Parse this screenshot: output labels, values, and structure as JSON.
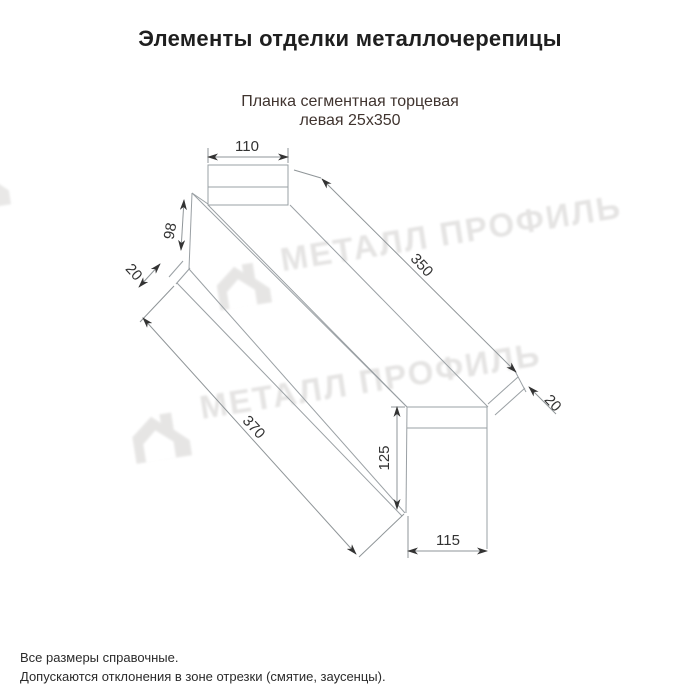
{
  "title": "Элементы отделки металлочерепицы",
  "subtitle_line1": "Планка сегментная торцевая",
  "subtitle_line2": "левая 25x350",
  "watermark_text": "МЕТАЛЛ ПРОФИЛЬ",
  "dimensions": {
    "top_width": "110",
    "left_edge": "98",
    "left_hem": "20",
    "top_length": "350",
    "bottom_length": "370",
    "right_hem": "20",
    "right_height": "125",
    "bottom_width": "115"
  },
  "footnotes": [
    "Все размеры справочные.",
    "Допускаются отклонения в зоне отрезки (смятие, заусенцы)."
  ],
  "colors": {
    "title": "#1f1f1f",
    "subtitle": "#40342f",
    "drawing_line": "#9aa0a4",
    "dimension_text": "#333333",
    "watermark": "#e2e1e0"
  }
}
